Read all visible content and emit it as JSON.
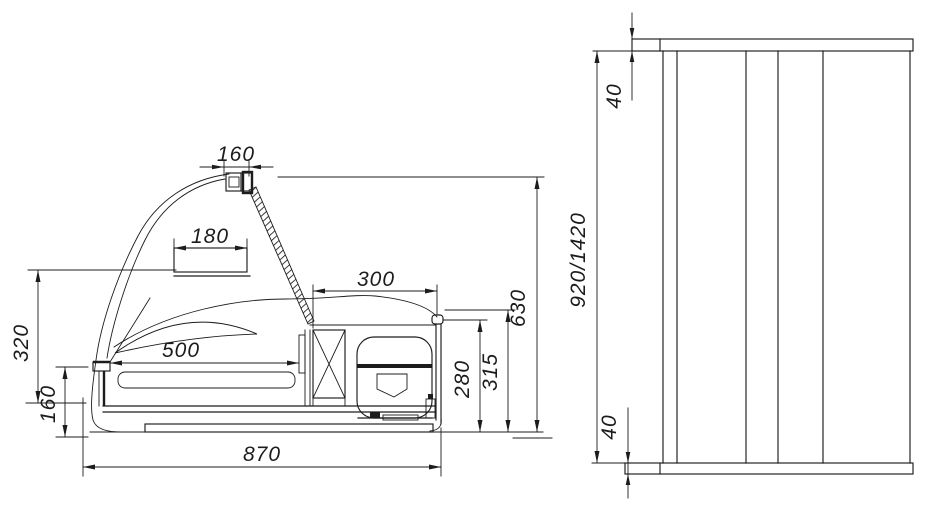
{
  "drawing": {
    "type": "technical-dimension-drawing",
    "line_color": "#1c1c1c",
    "background_color": "#ffffff"
  },
  "side_view": {
    "dims": {
      "lamp_width": "160",
      "display_shelf_width": "180",
      "tray_length": "500",
      "machine_compartment_width": "300",
      "glass_front_height": "320",
      "front_panel_height": "160",
      "overall_length": "870",
      "compartment_inner_height": "280",
      "compartment_height": "315",
      "overall_height": "630"
    }
  },
  "rear_view": {
    "dims": {
      "top_cap_thickness": "40",
      "panel_height": "920/1420",
      "bottom_cap_thickness": "40"
    }
  }
}
